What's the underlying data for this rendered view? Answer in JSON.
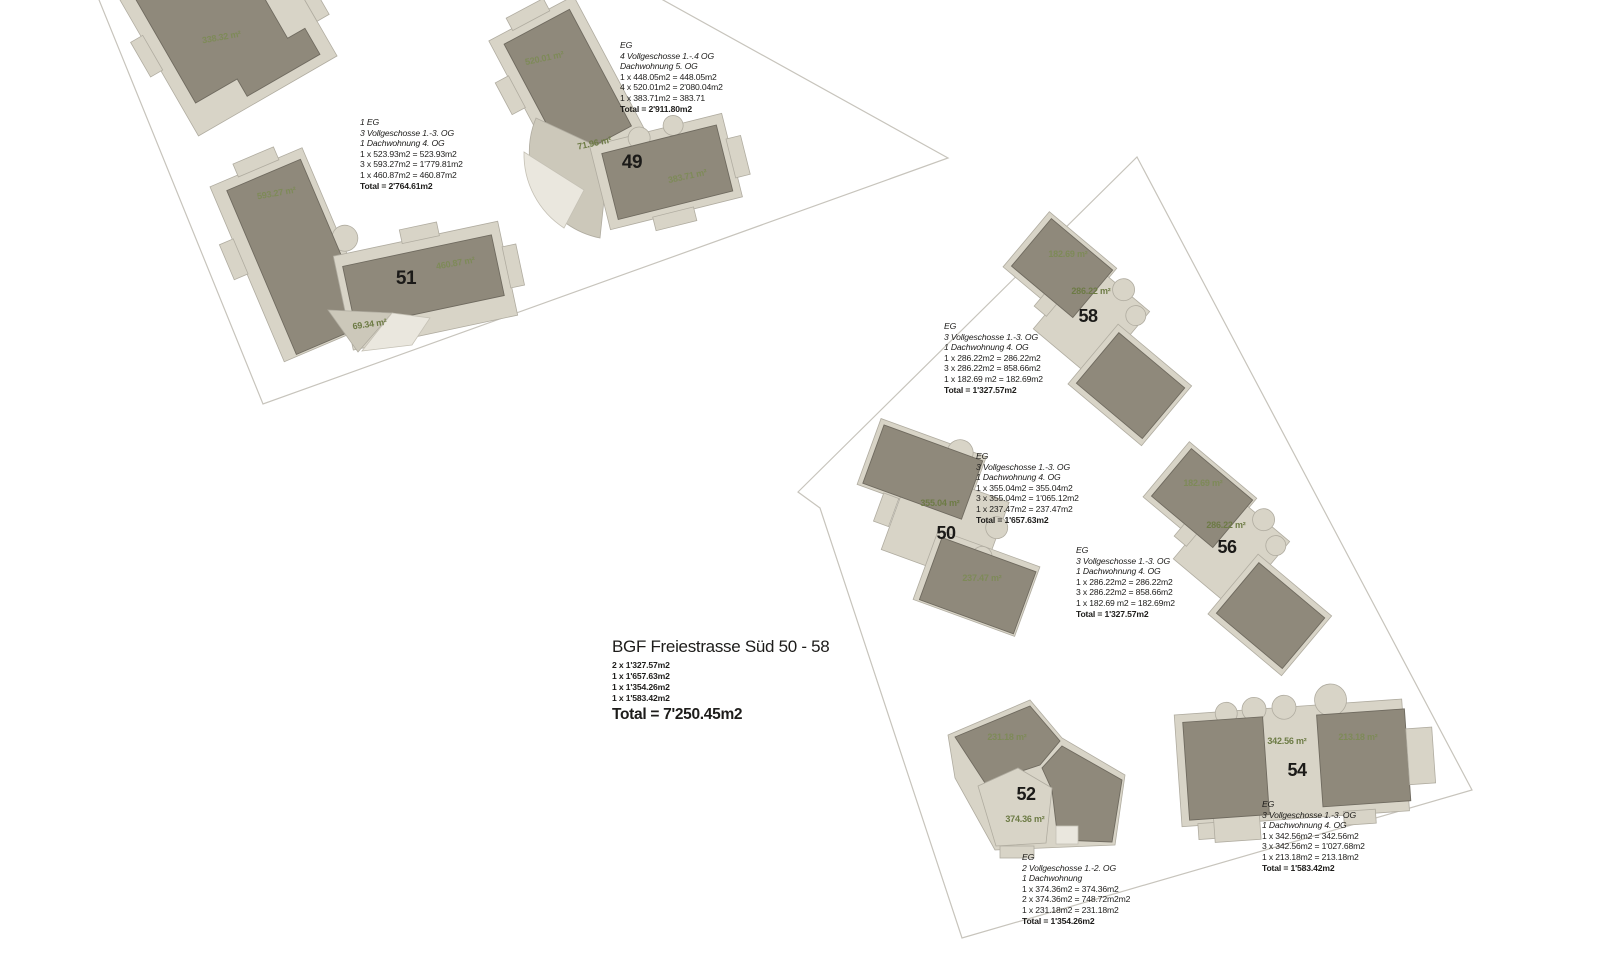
{
  "plan": {
    "title_block": {
      "title": "BGF Freiestrasse Süd 50 - 58",
      "sum_lines": [
        "2 x 1'327.57m2",
        "1 x 1'657.63m2",
        "1 x 1'354.26m2",
        "1 x 1'583.42m2"
      ],
      "total": "Total = 7'250.45m2"
    }
  },
  "colors": {
    "building_dark": "#8f897b",
    "building_light": "#d8d4c7",
    "building_lighter": "#eae7de",
    "parcel_boundary": "#c7c4bc",
    "area_label_green": "#6d7b45",
    "text": "#1d1c1a"
  },
  "buildings": [
    {
      "name": "partial-building",
      "area_labels": [
        "338.32 m²"
      ]
    },
    {
      "name": "building-51",
      "number": "51",
      "area_labels": [
        "593.27 m²",
        "460.87 m²",
        "69.34 m²"
      ],
      "annotation": {
        "usage_lines": [
          "1 EG",
          "3 Vollgeschosse 1.-3. OG",
          "1 Dachwohnung 4. OG"
        ],
        "calc_lines": [
          "1 x 523.93m2 = 523.93m2",
          "3 x 593.27m2 = 1'779.81m2",
          "1 x 460.87m2 = 460.87m2"
        ],
        "total": "Total = 2'764.61m2"
      }
    },
    {
      "name": "building-49",
      "number": "49",
      "area_labels": [
        "520.01 m²",
        "71.96 m²",
        "383.71 m²"
      ],
      "annotation": {
        "usage_lines": [
          "EG",
          "4 Vollgeschosse 1.-.4 OG",
          "Dachwohnung 5. OG"
        ],
        "calc_lines": [
          "1 x 448.05m2 = 448.05m2",
          "4 x 520.01m2 = 2'080.04m2",
          "1 x 383.71m2 = 383.71"
        ],
        "total": "Total = 2'911.80m2"
      }
    },
    {
      "name": "building-58",
      "number": "58",
      "area_labels": [
        "182.69 m²",
        "286.22 m²"
      ],
      "annotation": {
        "usage_lines": [
          "EG",
          "3 Vollgeschosse 1.-3. OG",
          "1 Dachwohnung 4. OG"
        ],
        "calc_lines": [
          "1 x 286.22m2 = 286.22m2",
          "3 x 286.22m2 = 858.66m2",
          "1 x 182.69 m2 = 182.69m2"
        ],
        "total": "Total = 1'327.57m2"
      }
    },
    {
      "name": "building-50",
      "number": "50",
      "area_labels": [
        "355.04 m²",
        "237.47 m²"
      ],
      "annotation": {
        "usage_lines": [
          "EG",
          "3 Vollgeschosse 1.-3. OG",
          "1 Dachwohnung 4. OG"
        ],
        "calc_lines": [
          "1 x 355.04m2 = 355.04m2",
          "3 x 355.04m2 = 1'065.12m2",
          "1 x 237.47m2 = 237.47m2"
        ],
        "total": "Total = 1'657.63m2"
      }
    },
    {
      "name": "building-56",
      "number": "56",
      "area_labels": [
        "182.69 m²",
        "286.22 m²"
      ],
      "annotation": {
        "usage_lines": [
          "EG",
          "3 Vollgeschosse 1.-3. OG",
          "1 Dachwohnung 4. OG"
        ],
        "calc_lines": [
          "1 x 286.22m2 = 286.22m2",
          "3 x 286.22m2 = 858.66m2",
          "1 x 182.69 m2 = 182.69m2"
        ],
        "total": "Total = 1'327.57m2"
      }
    },
    {
      "name": "building-52",
      "number": "52",
      "area_labels": [
        "231.18 m²",
        "374.36 m²"
      ],
      "annotation": {
        "usage_lines": [
          "EG",
          "2 Vollgeschosse 1.-2. OG",
          "1 Dachwohnung"
        ],
        "calc_lines": [
          "1 x 374.36m2 = 374.36m2",
          "2 x 374.36m2 = 748.72m2m2",
          "1 x 231.18m2 = 231.18m2"
        ],
        "total": "Total = 1'354.26m2"
      }
    },
    {
      "name": "building-54",
      "number": "54",
      "area_labels": [
        "342.56 m²",
        "213.18 m²"
      ],
      "annotation": {
        "usage_lines": [
          "EG",
          "3 Vollgeschosse 1.-3. OG",
          "1 Dachwohnung 4. OG"
        ],
        "calc_lines": [
          "1 x 342.56m2 = 342.56m2",
          "3 x 342.56m2 = 1'027.68m2",
          "1 x 213.18m2 = 213.18m2"
        ],
        "total": "Total = 1'583.42m2"
      }
    }
  ]
}
